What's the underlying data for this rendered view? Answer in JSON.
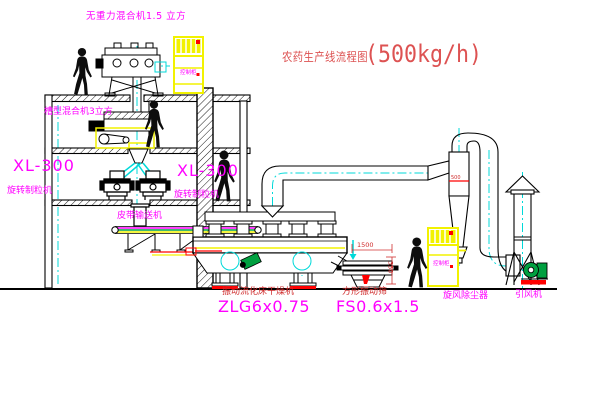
{
  "title": {
    "text": "农药生产线流程图",
    "capacity": "(500kg/h)"
  },
  "equipment_labels": {
    "top_mixer": "无重力混合机1.5 立方",
    "second_mixer": "槽型混合机3立方",
    "granulator_1": {
      "model": "XL-300",
      "name": "旋转制粒机"
    },
    "granulator_2": {
      "model": "XL-300",
      "name": "旋转制粒机"
    },
    "belt_conveyor": "皮带输送机",
    "dryer": {
      "name": "振动流化床干燥机",
      "model": "ZLG6x0.75"
    },
    "sieve": {
      "name": "方形振动筛",
      "model": "FS0.6x1.5"
    },
    "cyclone": "旋风除尘器",
    "fan": "引风机"
  },
  "dimensions": {
    "sieve_length": "1500",
    "sieve_height": "350",
    "cyclone_mark": "500"
  },
  "cabinet_text": "控制柜",
  "colors": {
    "magenta_label": "#ff00ff",
    "red_label": "#cf2b2b",
    "title_red": "#dd5252",
    "equipment_yellow": "#f2f200",
    "centerline_cyan": "#00d9d9",
    "motor_green": "#00a040",
    "line_black": "#000000"
  }
}
